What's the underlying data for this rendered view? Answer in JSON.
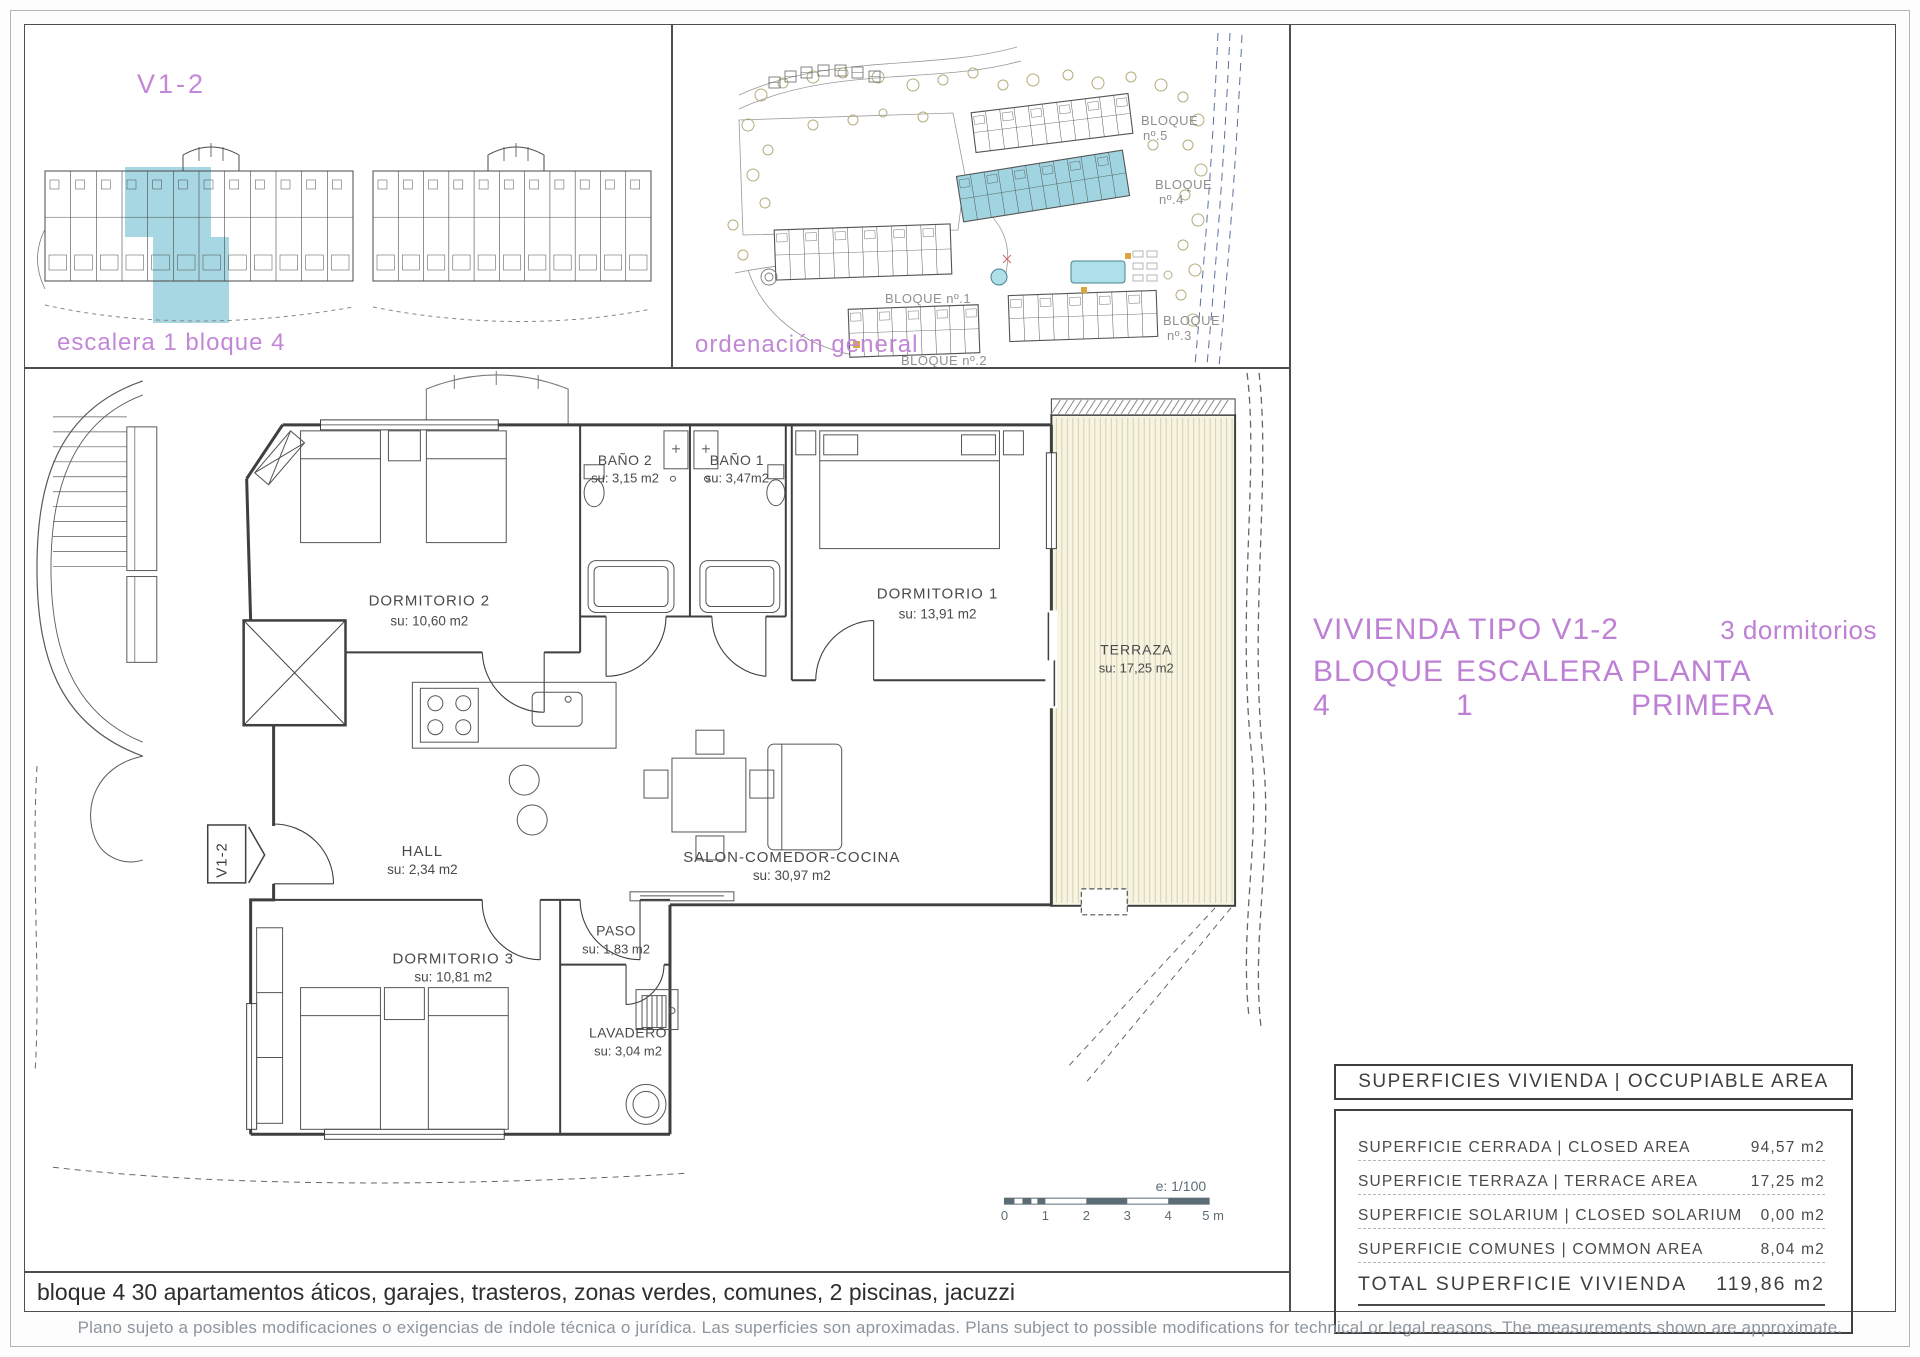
{
  "unit": {
    "label": "V1-2",
    "caption": "escalera 1 bloque 4"
  },
  "site": {
    "caption": "ordenación general",
    "blocks": [
      {
        "l1": "BLOQUE",
        "l2": "nº.5"
      },
      {
        "l1": "BLOQUE",
        "l2": "nº.4"
      },
      {
        "l1": "BLOQUE nº.1",
        "l2": ""
      },
      {
        "l1": "BLOQUE nº.2",
        "l2": ""
      },
      {
        "l1": "BLOQUE",
        "l2": "nº.3"
      }
    ]
  },
  "title": {
    "line1_left": "VIVIENDA TIPO V1-2",
    "line1_right": "3 dormitorios",
    "line2_segments": [
      "BLOQUE 4",
      "ESCALERA 1",
      "PLANTA PRIMERA"
    ]
  },
  "floor_plan": {
    "marker": "V1-2",
    "rooms": [
      {
        "name": "DORMITORIO 2",
        "area": "su: 10,60 m2"
      },
      {
        "name": "BAÑO 2",
        "area": "su: 3,15 m2"
      },
      {
        "name": "BAÑO 1",
        "area": "su: 3,47m2"
      },
      {
        "name": "DORMITORIO 1",
        "area": "su: 13,91 m2"
      },
      {
        "name": "TERRAZA",
        "area": "su: 17,25 m2"
      },
      {
        "name": "HALL",
        "area": "su: 2,34 m2"
      },
      {
        "name": "SALON-COMEDOR-COCINA",
        "area": "su: 30,97 m2"
      },
      {
        "name": "DORMITORIO 3",
        "area": "su: 10,81 m2"
      },
      {
        "name": "PASO",
        "area": "su: 1,83 m2"
      },
      {
        "name": "LAVADERO",
        "area": "su: 3,04 m2"
      }
    ],
    "scale": {
      "label": "e: 1/100",
      "ticks": [
        "0",
        "1",
        "2",
        "3",
        "4",
        "5 m"
      ]
    }
  },
  "areas_table": {
    "header": "SUPERFICIES VIVIENDA | OCCUPIABLE AREA",
    "rows": [
      {
        "label": "SUPERFICIE CERRADA | CLOSED AREA",
        "value": "94,57 m2"
      },
      {
        "label": "SUPERFICIE TERRAZA  | TERRACE AREA",
        "value": "17,25 m2"
      },
      {
        "label": "SUPERFICIE SOLARIUM | CLOSED SOLARIUM",
        "value": "0,00 m2"
      },
      {
        "label": "SUPERFICIE COMUNES | COMMON AREA",
        "value": "8,04 m2"
      }
    ],
    "total_label": "TOTAL SUPERFICIE VIVIENDA",
    "total_value": "119,86 m2"
  },
  "notes": {
    "bottom": "bloque 4 30 apartamentos áticos, garajes, trasteros, zonas verdes, comunes, 2 piscinas, jacuzzi",
    "footer": "Plano sujeto a posibles modificaciones o exigencias de índole técnica o jurídica. Las superficies son aproximadas. Plans subject to possible modifications for technical or legal reasons. The measurements shown are approximate."
  },
  "colors": {
    "accent_purple": "#bd80d5",
    "highlight_cyan": "#9fd4e0",
    "terrace_cream": "#f7f4e4",
    "scale_slate": "#5c6c75"
  }
}
